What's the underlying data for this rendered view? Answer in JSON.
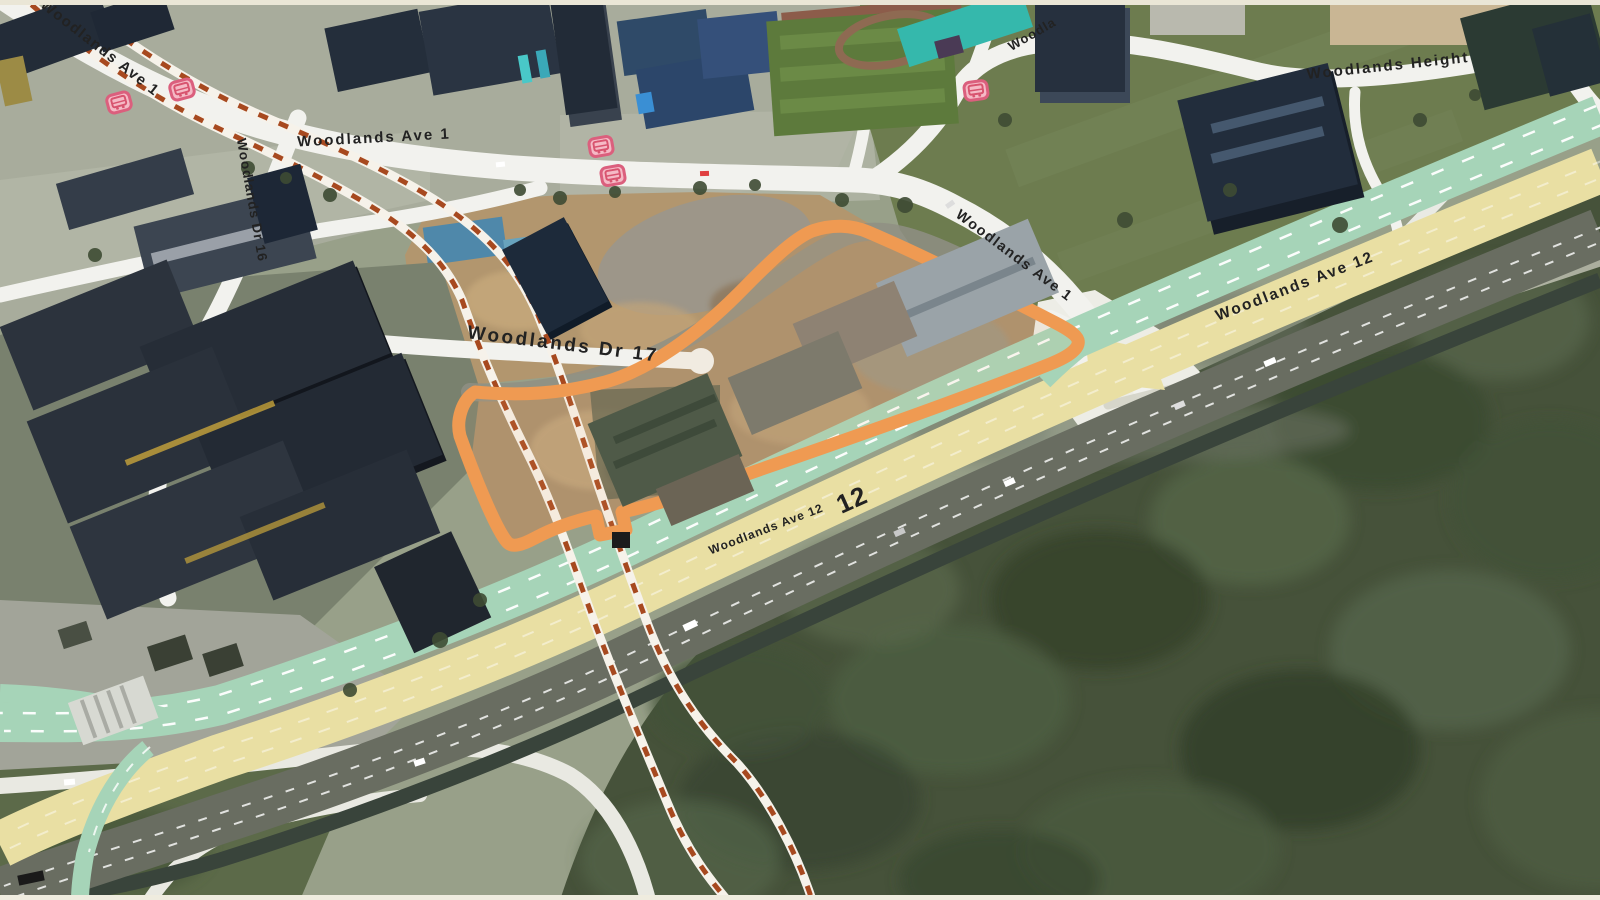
{
  "map": {
    "title": "Woodlands 3D aerial map",
    "labels": [
      {
        "id": "woodlands-ave-1-topleft",
        "text": "Woodlands Ave 1"
      },
      {
        "id": "woodlands-ave-1-top",
        "text": "Woodlands Ave 1"
      },
      {
        "id": "woodlands-dr-16",
        "text": "Woodlands Dr 16"
      },
      {
        "id": "woodlands-dr-17",
        "text": "Woodlands Dr 17"
      },
      {
        "id": "woodlands-cut-off",
        "text": "Woodla"
      },
      {
        "id": "woodlands-height",
        "text": "Woodlands Height"
      },
      {
        "id": "woodlands-ave-1-right",
        "text": "Woodlands Ave 1"
      },
      {
        "id": "woodlands-ave-12-upper",
        "text": "Woodlands Ave 12"
      },
      {
        "id": "woodlands-ave-12-lower",
        "text": "Woodlands Ave 12"
      },
      {
        "id": "woodlands-ave-12-number",
        "text": "12"
      }
    ],
    "markers": {
      "bus_stop_count": 5,
      "bus_stop_icon": "bus-stop-icon",
      "bus_stop_color": "#db5f7d"
    },
    "site_boundary": {
      "color": "#ef9a52",
      "style": "thick solid outline with notch",
      "fill": "none"
    },
    "rail_under_construction": {
      "line_count": 2,
      "style": "dashed",
      "dash_color": "#a7491f",
      "band_color": "#f6f2ea"
    },
    "road_colors": {
      "expressway_overlay": "#e9dfa3",
      "green_overlay": "#a6d4b8",
      "local_road": "#f2f2ee",
      "carriageway": "#696d61",
      "canal": "#39443b"
    },
    "terrain_colors": {
      "urban_ground": "#a8ac9c",
      "grass_field": "#6d7c4f",
      "construction_dirt": "#b2966e",
      "forest": "#46523a"
    }
  }
}
